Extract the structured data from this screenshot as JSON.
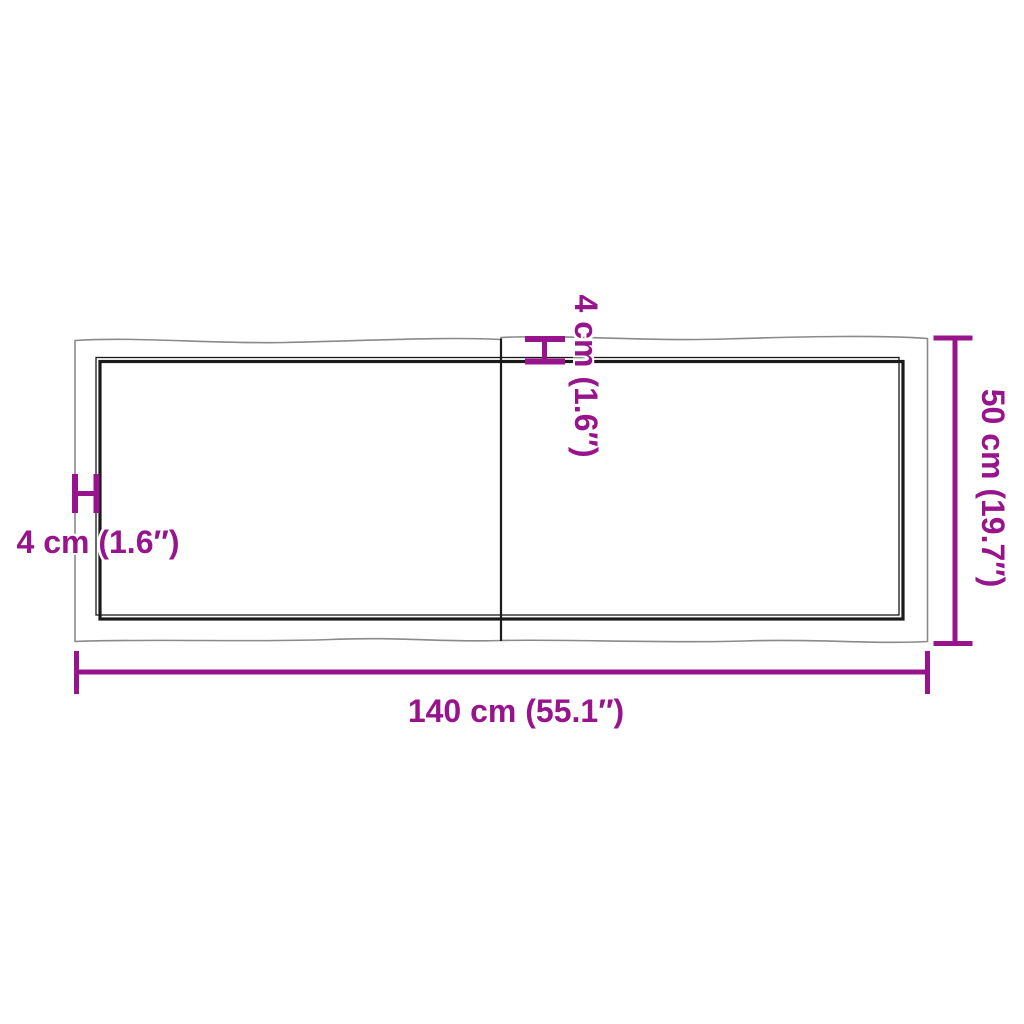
{
  "colors": {
    "accent": "#97148C",
    "outline": "#8a8a8a",
    "ink": "#1a1a1a",
    "background": "#ffffff"
  },
  "diagram": {
    "description": "Top-view dimension drawing of a two-plank live-edge table top",
    "labels": {
      "width": "140 cm (55.1″)",
      "height": "50 cm (19.7″)",
      "thickness_left": "4 cm (1.6″)",
      "thickness_top": "4 cm (1.6″)"
    }
  }
}
